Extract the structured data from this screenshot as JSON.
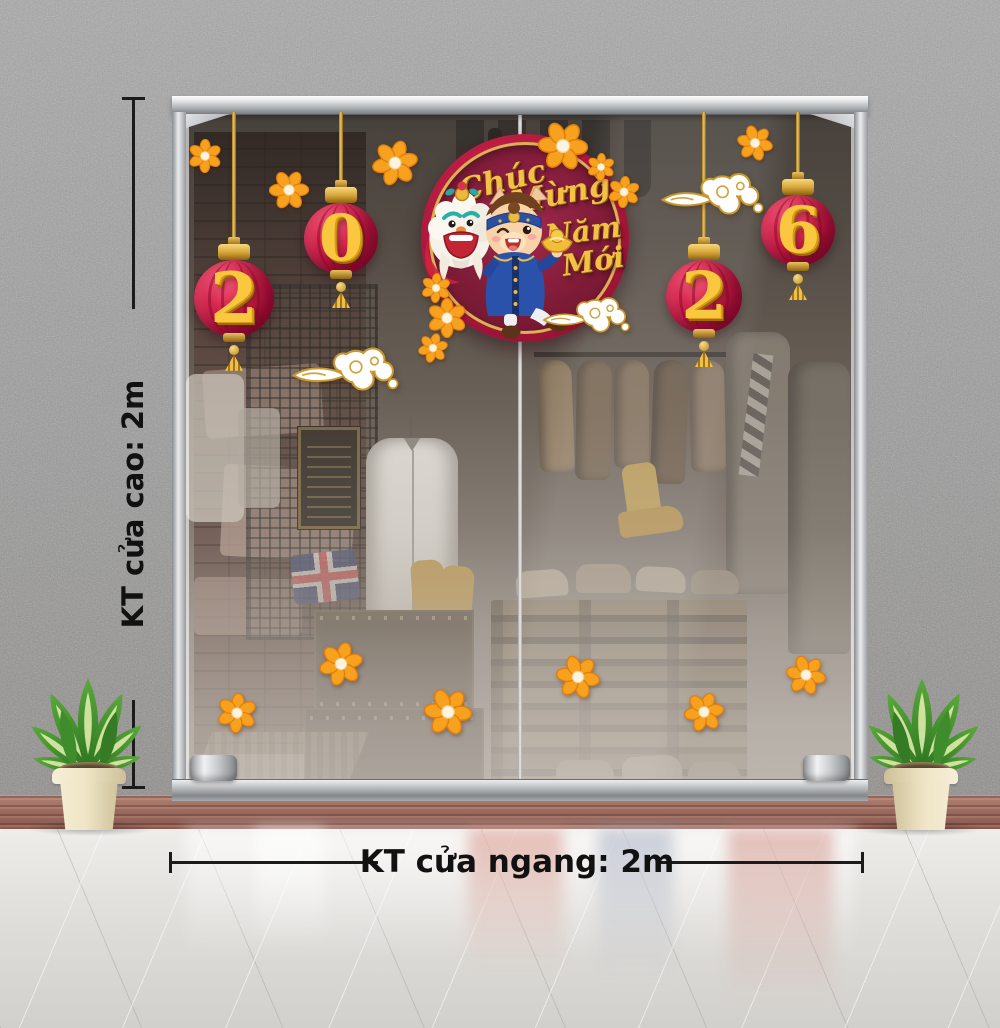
{
  "annotations": {
    "door_height_label": "KT cửa cao: 2m",
    "door_width_label": "KT cửa ngang: 2m"
  },
  "decal": {
    "greeting_words": [
      "Chúc",
      "Mừng",
      "Năm",
      "Mới"
    ],
    "greeting_full": "Chúc Mừng Năm Mới",
    "year": "2026"
  },
  "stickers": {
    "lanterns": [
      {
        "digit": "2",
        "x": 234,
        "y": 300,
        "r": 40
      },
      {
        "digit": "0",
        "x": 341,
        "y": 240,
        "r": 37
      },
      {
        "digit": "2",
        "x": 704,
        "y": 298,
        "r": 38
      },
      {
        "digit": "6",
        "x": 798,
        "y": 232,
        "r": 37
      }
    ],
    "flowers": [
      {
        "x": 205,
        "y": 156,
        "s": 34
      },
      {
        "x": 289,
        "y": 190,
        "s": 40
      },
      {
        "x": 395,
        "y": 163,
        "s": 46
      },
      {
        "x": 563,
        "y": 146,
        "s": 50
      },
      {
        "x": 601,
        "y": 167,
        "s": 28
      },
      {
        "x": 624,
        "y": 192,
        "s": 32
      },
      {
        "x": 755,
        "y": 143,
        "s": 36
      },
      {
        "x": 436,
        "y": 288,
        "s": 30
      },
      {
        "x": 447,
        "y": 318,
        "s": 40
      },
      {
        "x": 433,
        "y": 348,
        "s": 30
      },
      {
        "x": 237,
        "y": 713,
        "s": 40
      },
      {
        "x": 341,
        "y": 664,
        "s": 44
      },
      {
        "x": 448,
        "y": 712,
        "s": 48
      },
      {
        "x": 578,
        "y": 677,
        "s": 44
      },
      {
        "x": 704,
        "y": 712,
        "s": 40
      },
      {
        "x": 806,
        "y": 675,
        "s": 40
      }
    ],
    "clouds": [
      {
        "x": 345,
        "y": 365,
        "w": 110
      },
      {
        "x": 586,
        "y": 312,
        "w": 90
      },
      {
        "x": 712,
        "y": 190,
        "w": 106
      }
    ]
  },
  "colors": {
    "lantern_red": "#c0173d",
    "badge_maroon": "#7c1a34",
    "gold": "#e9b33c",
    "flower_orange": "#f7a11f",
    "wall_gray": "#9b9b9b",
    "wood_floor": "#9a6a5e",
    "glossy_floor": "#e2e0dc",
    "frame_silver": "#c9ccce",
    "leaf_green": "#3d8c2c",
    "pot_cream": "#ede3c4",
    "dimension_line": "#1b1b1b"
  }
}
